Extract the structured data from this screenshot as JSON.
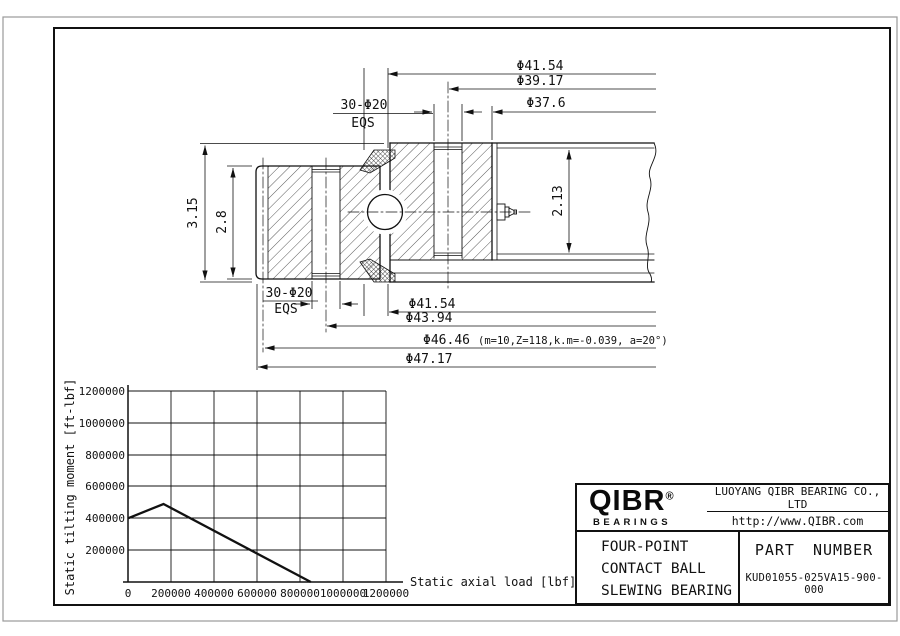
{
  "colors": {
    "line": "#111111",
    "border_outer": "#9a9a9a",
    "background": "#ffffff"
  },
  "drawing": {
    "dim_top_1": "Φ41.54",
    "dim_top_2": "Φ39.17",
    "dim_top_3": "Φ37.6",
    "bolt_label": "30-Φ20",
    "bolt_label2": "EQS",
    "dim_height_outer": "3.15",
    "dim_height_inner": "2.8",
    "dim_height_right": "2.13",
    "dim_bot_1": "Φ41.54",
    "dim_bot_2": "Φ43.94",
    "dim_bot_3": "Φ46.46",
    "dim_bot_3_note": "(m=10,Z=118,k.m=-0.039, a=20°)",
    "dim_bot_4": "Φ47.17"
  },
  "chart_data": {
    "type": "line",
    "title": "",
    "xlabel": "Static axial load [lbf]",
    "ylabel": "Static tilting moment [ft-lbf]",
    "xlim": [
      0,
      1200000
    ],
    "ylim": [
      0,
      1200000
    ],
    "grid": true,
    "legend": "none",
    "x_ticks": [
      0,
      200000,
      400000,
      600000,
      800000,
      1000000,
      1200000
    ],
    "y_ticks": [
      200000,
      400000,
      600000,
      800000,
      1000000,
      1200000
    ],
    "series": [
      {
        "name": "static capacity curve",
        "points": [
          [
            0,
            400000
          ],
          [
            165000,
            490000
          ],
          [
            850000,
            0
          ]
        ]
      }
    ]
  },
  "title_block": {
    "brand": "QIBR",
    "brand_reg": "®",
    "brand_sub": "BEARINGS",
    "company": "LUOYANG QIBR BEARING CO., LTD",
    "website": "http://www.QIBR.com",
    "product_line1": "FOUR-POINT",
    "product_line2": "CONTACT BALL",
    "product_line3": "SLEWING BEARING",
    "part_label": "PART NUMBER",
    "part_number": "KUD01055-025VA15-900-000"
  }
}
